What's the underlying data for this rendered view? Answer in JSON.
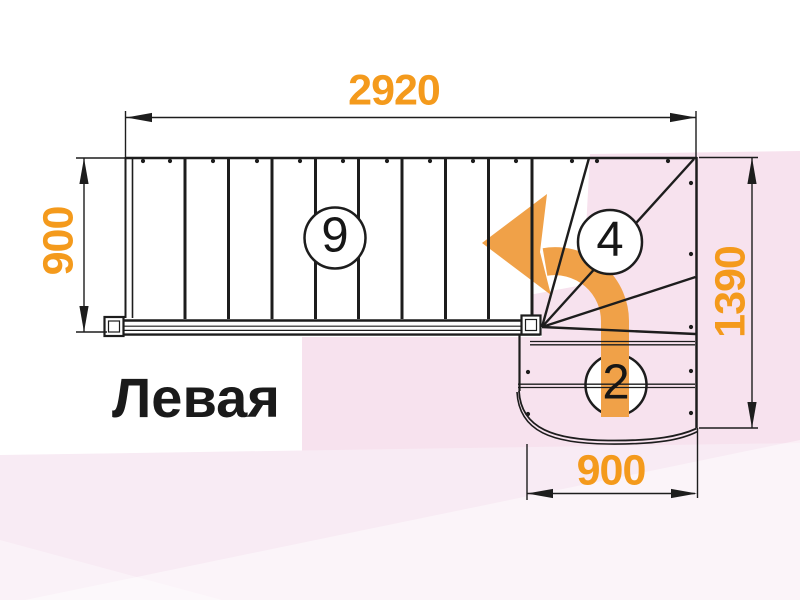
{
  "title": "Левая",
  "dimensions": {
    "top": "2920",
    "left": "900",
    "right": "1390",
    "bottom": "900"
  },
  "steps": {
    "main_flight": "9",
    "winders": "4",
    "bottom_flight": "2"
  },
  "icons": {
    "direction_arrow": "turn-left-curved-arrow"
  },
  "colors": {
    "dimension_text": "#f49a1c",
    "arrow_fill": "#f0a148",
    "line": "#1d1d1d",
    "bg_pink": "#f7e2ee",
    "bg_pink_light": "#f8ebf4",
    "tread_fill": "#ffffff"
  }
}
